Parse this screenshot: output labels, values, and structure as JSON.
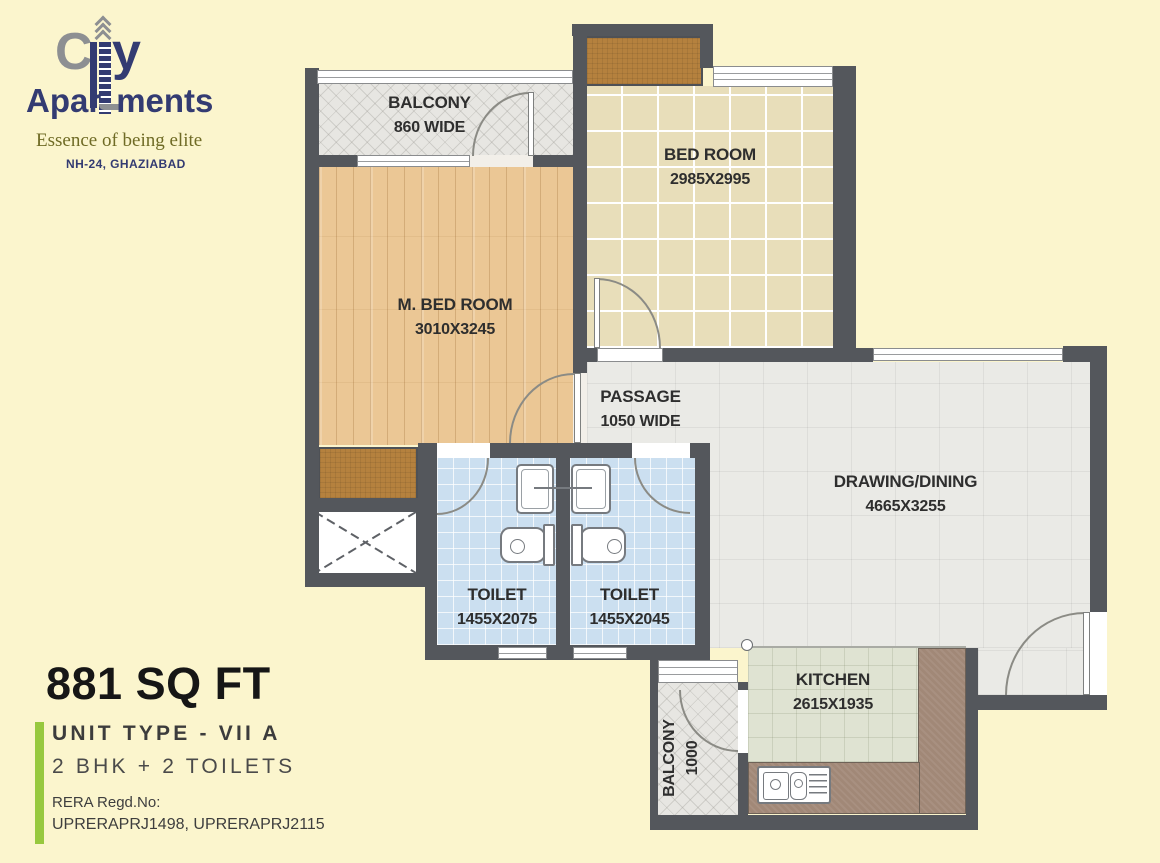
{
  "colors": {
    "page-bg": "#FBF5CD",
    "wall": "#54575C",
    "accent-green": "#97C83E",
    "brand-navy": "#333B72",
    "brand-gray": "#8D8F92",
    "tagline-olive": "#6F6B25",
    "wood": "#EBC795",
    "tile-tan": "#E8DEBA",
    "tile-blue": "#CBDFF0",
    "floor-gray": "#EAEAE6",
    "kitchen-floor": "#DFE3D2",
    "counter": "#A18877",
    "wardrobe": "#B5813E"
  },
  "brand": {
    "city_c": "C",
    "city_y": "y",
    "apartments_pre": "Apar",
    "apartments_post": "ments",
    "tagline": "Essence of being elite",
    "location": "NH-24, GHAZIABAD"
  },
  "rooms": {
    "balcony_top": {
      "name": "BALCONY",
      "dim": "860 WIDE"
    },
    "bedroom": {
      "name": "BED ROOM",
      "dim": "2985X2995"
    },
    "master_bedroom": {
      "name": "M. BED ROOM",
      "dim": "3010X3245"
    },
    "passage": {
      "name": "PASSAGE",
      "dim": "1050 WIDE"
    },
    "drawing_dining": {
      "name": "DRAWING/DINING",
      "dim": "4665X3255"
    },
    "toilet_1": {
      "name": "TOILET",
      "dim": "1455X2075"
    },
    "toilet_2": {
      "name": "TOILET",
      "dim": "1455X2045"
    },
    "kitchen": {
      "name": "KITCHEN",
      "dim": "2615X1935"
    },
    "balcony_kitchen": {
      "name": "BALCONY",
      "dim": "1000"
    }
  },
  "unit": {
    "area": "881 SQ FT",
    "type": "UNIT TYPE - VII A",
    "configuration": "2 BHK + 2 TOILETS",
    "rera_label": "RERA Regd.No:",
    "rera_numbers": "UPRERAPRJ1498, UPRERAPRJ2115"
  }
}
